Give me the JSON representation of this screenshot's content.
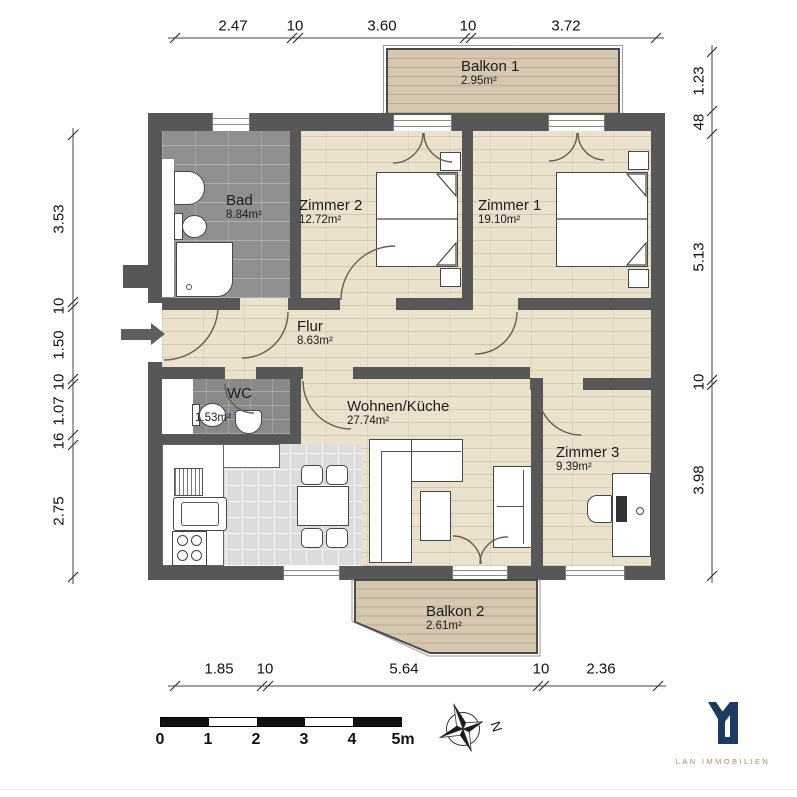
{
  "plan": {
    "rooms": [
      {
        "name": "Balkon 1",
        "area": "2.95m²"
      },
      {
        "name": "Bad",
        "area": "8.84m²"
      },
      {
        "name": "Zimmer 2",
        "area": "12.72m²"
      },
      {
        "name": "Zimmer 1",
        "area": "19.10m²"
      },
      {
        "name": "Flur",
        "area": "8.63m²"
      },
      {
        "name": "WC",
        "area": "1.53m²"
      },
      {
        "name": "Wohnen/Küche",
        "area": "27.74m²"
      },
      {
        "name": "Zimmer 3",
        "area": "9.39m²"
      },
      {
        "name": "Balkon 2",
        "area": "2.61m²"
      }
    ],
    "dimensions": {
      "top": [
        "2.47",
        "10",
        "3.60",
        "10",
        "3.72"
      ],
      "bottom": [
        "1.85",
        "10",
        "5.64",
        "10",
        "2.36"
      ],
      "left": [
        "3.53",
        "10",
        "1.50",
        "10",
        "1.07",
        "16",
        "2.75"
      ],
      "right": [
        "1.23",
        "48",
        "5.13",
        "10",
        "3.98"
      ]
    },
    "scale_bar": {
      "labels": [
        "0",
        "1",
        "2",
        "3",
        "4",
        "5m"
      ]
    },
    "compass": {
      "north_label": "N"
    },
    "branding": {
      "logo_text": "LAN IMMOBILIEN"
    },
    "colors": {
      "wall": "#575757",
      "wood_floor": "#ebe2cd",
      "bath_tile": "#8f8f8f",
      "kitchen_tile": "#dcdcdc",
      "balcony_deck": "#d6c8b0",
      "logo_navy": "#1d3a5f",
      "logo_gold": "#b08f63"
    }
  }
}
